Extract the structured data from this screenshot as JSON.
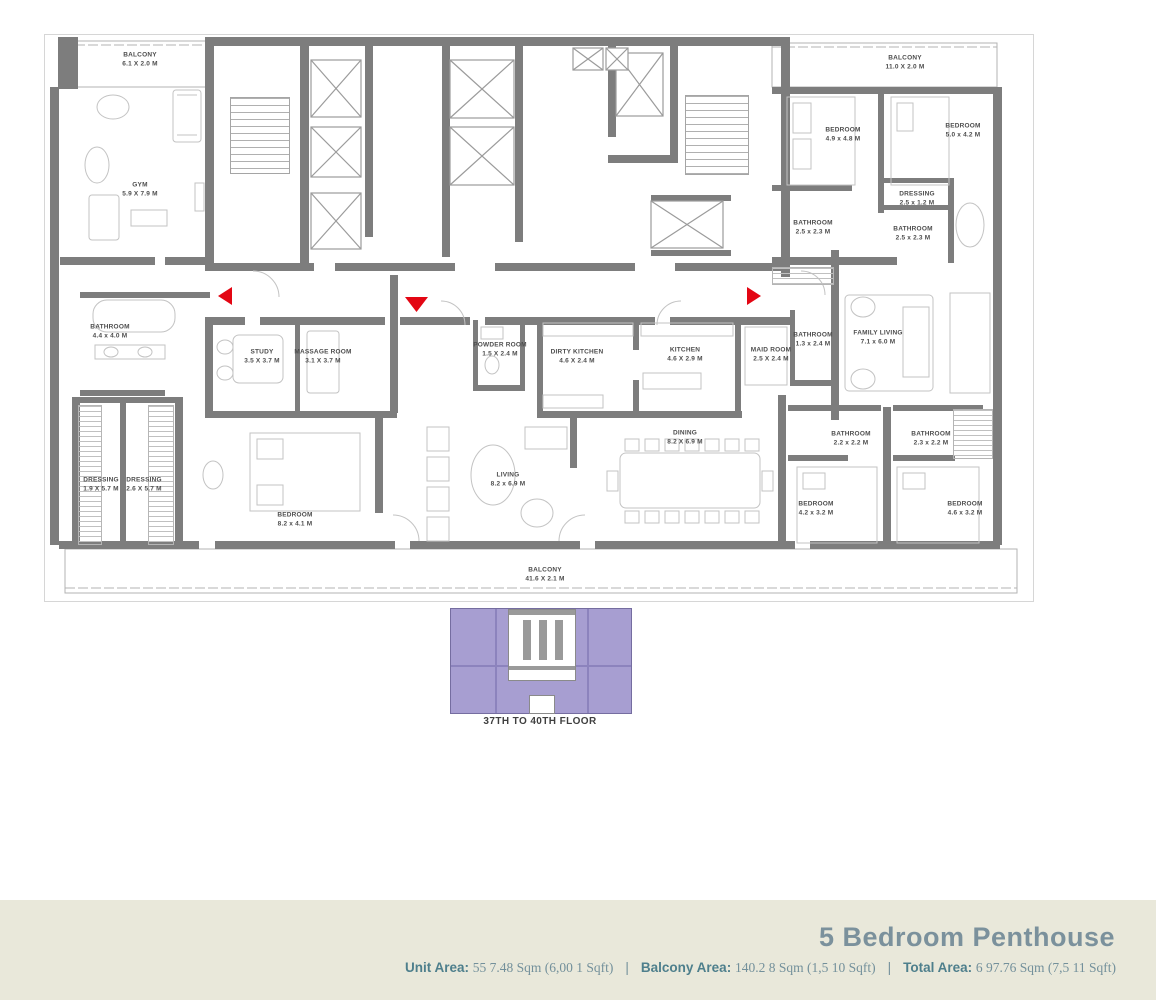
{
  "plan": {
    "rooms": [
      {
        "name": "BALCONY",
        "dims": "6.1 X 2.0 M"
      },
      {
        "name": "GYM",
        "dims": "5.9 X 7.9 M"
      },
      {
        "name": "BATHROOM",
        "dims": "4.4 x 4.0 M"
      },
      {
        "name": "DRESSING",
        "dims": "1.9 X 5.7 M"
      },
      {
        "name": "DRESSING",
        "dims": "2.6 X 5.7 M"
      },
      {
        "name": "STUDY",
        "dims": "3.5 X 3.7 M"
      },
      {
        "name": "MASSAGE ROOM",
        "dims": "3.1 X 3.7 M"
      },
      {
        "name": "POWDER ROOM",
        "dims": "1.5 X 2.4 M"
      },
      {
        "name": "DIRTY KITCHEN",
        "dims": "4.6 X 2.4 M"
      },
      {
        "name": "KITCHEN",
        "dims": "4.6 X 2.9 M"
      },
      {
        "name": "MAID ROOM",
        "dims": "2.5 X 2.4 M"
      },
      {
        "name": "BATHROOM",
        "dims": "1.3 x 2.4 M"
      },
      {
        "name": "FAMILY LIVING",
        "dims": "7.1 x 6.0 M"
      },
      {
        "name": "BALCONY",
        "dims": "11.0 X 2.0 M"
      },
      {
        "name": "BEDROOM",
        "dims": "4.9 x 4.8 M"
      },
      {
        "name": "BEDROOM",
        "dims": "5.0 x 4.2 M"
      },
      {
        "name": "BATHROOM",
        "dims": "2.5 x 2.3 M"
      },
      {
        "name": "DRESSING",
        "dims": "2.5 x 1.2 M"
      },
      {
        "name": "BATHROOM",
        "dims": "2.5 x 2.3 M"
      },
      {
        "name": "BEDROOM",
        "dims": "8.2 x 4.1 M"
      },
      {
        "name": "LIVING",
        "dims": "8.2 x 6.9 M"
      },
      {
        "name": "DINING",
        "dims": "8.2 X 6.9 M"
      },
      {
        "name": "BATHROOM",
        "dims": "2.2 x 2.2 M"
      },
      {
        "name": "BATHROOM",
        "dims": "2.3 x 2.2 M"
      },
      {
        "name": "BEDROOM",
        "dims": "4.2 x 3.2 M"
      },
      {
        "name": "BEDROOM",
        "dims": "4.6 x 3.2 M"
      },
      {
        "name": "BALCONY",
        "dims": "41.6 X 2.1 M"
      }
    ],
    "key_plan": {
      "label": "37TH TO 40TH FLOOR"
    }
  },
  "footer": {
    "title": "5 Bedroom Penthouse",
    "areas": [
      {
        "label": "Unit Area:",
        "value": "55 7.48 Sqm (6,00 1 Sqft)"
      },
      {
        "label": "Balcony Area:",
        "value": "140.2 8 Sqm (1,5 10 Sqft)"
      },
      {
        "label": "Total Area:",
        "value": "6 97.76 Sqm (7,5 11 Sqft)"
      }
    ],
    "separator": "|"
  },
  "colors": {
    "wall_gray": "#7d7d7d",
    "accent_red": "#e30613",
    "keyplan_purple": "#a79ed1",
    "footer_bg": "#e9e8da",
    "footer_title": "#7b919c",
    "area_label_teal": "#4e7f8c"
  }
}
